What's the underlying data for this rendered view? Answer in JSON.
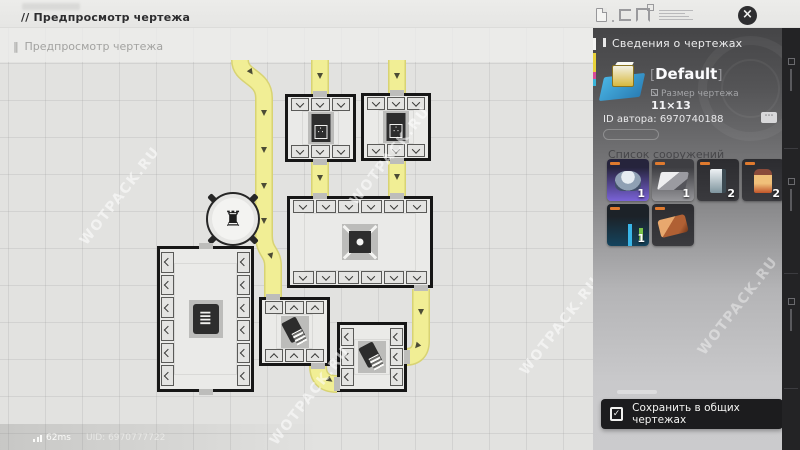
{
  "window": {
    "title": "// Предпросмотр чертежа",
    "subtitle_marker": "‖",
    "subtitle": "Предпросмотр чертежа",
    "watermark": "WOTPACK.RU"
  },
  "icons": {
    "close": "×",
    "more": "⋯",
    "check": "✓",
    "rook": "♜",
    "furnace_dots": "∴",
    "pipes": "≣"
  },
  "statusbar": {
    "ping": "62ms",
    "uid": "UID: 6970777722"
  },
  "sidebar": {
    "header": "Сведения о чертежах",
    "blueprint_name": "Default",
    "bracket_left": "[",
    "bracket_right": "]",
    "size_label": "Размер чертежа",
    "size_value": "11×13",
    "author_id": "ID автора: 6970740188",
    "structures_header": "Список сооружений",
    "structures": [
      {
        "icon": "dome",
        "variant": "purple",
        "count": "1"
      },
      {
        "icon": "assembler",
        "variant": "gray",
        "count": "1"
      },
      {
        "icon": "panel",
        "variant": "dark",
        "count": "2"
      },
      {
        "icon": "furnace",
        "variant": "dark",
        "count": "2"
      },
      {
        "icon": "frame",
        "variant": "blue",
        "count": "1"
      },
      {
        "icon": "plate",
        "variant": "dark",
        "count": ""
      }
    ],
    "save_label": "Сохранить в общих чертежах"
  },
  "blueprint_map": {
    "accent_belt": "#f1ee95",
    "belt_edge": "#d8d373",
    "rooms": [
      {
        "x": 285,
        "y": 66,
        "w": 71,
        "h": 68,
        "slots": {
          "top": 3,
          "bottom": 3
        },
        "chev": "down",
        "machine": "furnace"
      },
      {
        "x": 361,
        "y": 65,
        "w": 70,
        "h": 68,
        "slots": {
          "top": 3,
          "bottom": 3
        },
        "chev": "down",
        "machine": "furnace"
      },
      {
        "x": 287,
        "y": 168,
        "w": 146,
        "h": 92,
        "slots": {
          "top": 6,
          "bottom": 6
        },
        "chev": "down",
        "machine": "xdrill"
      },
      {
        "x": 157,
        "y": 218,
        "w": 97,
        "h": 146,
        "slots": {
          "left": 6,
          "right": 6
        },
        "chev": "left",
        "machine": "pipes"
      },
      {
        "x": 259,
        "y": 269,
        "w": 71,
        "h": 69,
        "slots": {
          "top": 3,
          "bottom": 3
        },
        "chev": "up",
        "machine": "drill"
      },
      {
        "x": 337,
        "y": 294,
        "w": 70,
        "h": 70,
        "slots": {
          "left": 3,
          "right": 3
        },
        "chev": "left",
        "machine": "drill"
      }
    ],
    "belts": [
      "M 240 32 C 240 50 264 48 264 70 L 264 208 C 264 224 273 224 273 238 L 273 270",
      "M 320 32 L 320 69",
      "M 397 32 L 397 68",
      "M 320 134 L 320 171",
      "M 397 133 L 397 170",
      "M 421 261 L 421 313 Q 421 329 405 329",
      "M 318 338 Q 318 356 337 356"
    ],
    "arrows": [
      {
        "x": 251,
        "y": 44,
        "a": -35
      },
      {
        "x": 264,
        "y": 85,
        "a": 0
      },
      {
        "x": 264,
        "y": 122,
        "a": 0
      },
      {
        "x": 264,
        "y": 158,
        "a": 0
      },
      {
        "x": 264,
        "y": 193,
        "a": 0
      },
      {
        "x": 271,
        "y": 228,
        "a": -15
      },
      {
        "x": 320,
        "y": 48,
        "a": 0
      },
      {
        "x": 397,
        "y": 48,
        "a": 0
      },
      {
        "x": 320,
        "y": 150,
        "a": 0
      },
      {
        "x": 397,
        "y": 149,
        "a": 0
      },
      {
        "x": 421,
        "y": 284,
        "a": 0
      },
      {
        "x": 417,
        "y": 318,
        "a": 40
      },
      {
        "x": 330,
        "y": 352,
        "a": -55
      }
    ],
    "doors": [
      {
        "x": 320,
        "y": 66
      },
      {
        "x": 320,
        "y": 134
      },
      {
        "x": 397,
        "y": 65
      },
      {
        "x": 397,
        "y": 133
      },
      {
        "x": 320,
        "y": 168
      },
      {
        "x": 397,
        "y": 168
      },
      {
        "x": 421,
        "y": 260
      },
      {
        "x": 273,
        "y": 269
      },
      {
        "x": 318,
        "y": 338
      },
      {
        "x": 337,
        "y": 356,
        "v": true
      },
      {
        "x": 407,
        "y": 329,
        "v": true
      },
      {
        "x": 206,
        "y": 218
      },
      {
        "x": 206,
        "y": 364
      }
    ],
    "operator": {
      "x": 233,
      "y": 191
    },
    "watermarks": [
      {
        "x": 60,
        "y": 160
      },
      {
        "x": 250,
        "y": 360
      },
      {
        "x": 500,
        "y": 290
      },
      {
        "x": 330,
        "y": 120
      }
    ]
  }
}
